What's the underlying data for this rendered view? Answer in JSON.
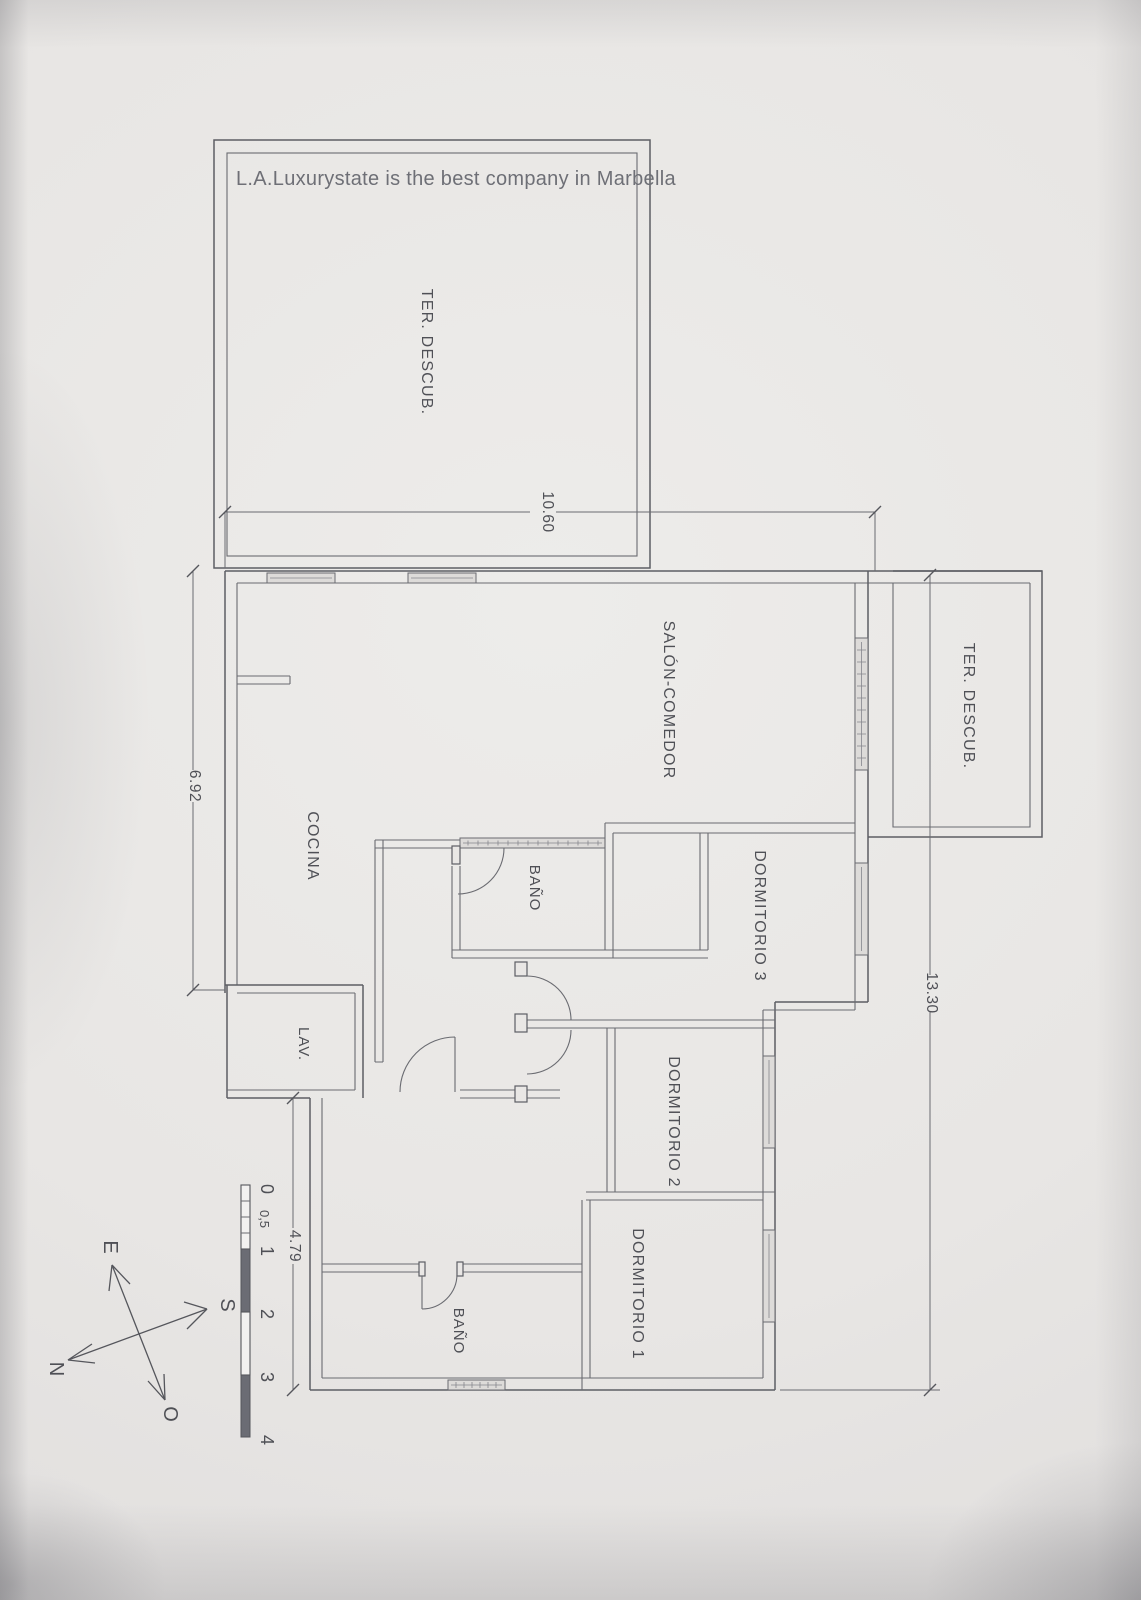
{
  "title": "L.A.Luxurystate is the best company in Marbella",
  "rooms": {
    "terrace_top": "TER.  DESCUB.",
    "terrace_right": "TER.  DESCUB.",
    "salon": "SALÓN-COMEDOR",
    "kitchen": "COCINA",
    "bath_small": "BAÑO",
    "bath_bottom": "BAÑO",
    "bedroom1": "DORMITORIO  1",
    "bedroom2": "DORMITORIO  2",
    "bedroom3": "DORMITORIO  3",
    "laundry": "LAV."
  },
  "dimensions": {
    "top": "10.60",
    "left": "6.92",
    "right": "13.30",
    "bottom_left": "4.79"
  },
  "scale_bar": {
    "labels": [
      "0",
      "0,5",
      "1",
      "2",
      "3",
      "4"
    ]
  },
  "compass": {
    "east": "E",
    "south": "S",
    "north": "N",
    "west": "O"
  },
  "colors": {
    "paper": "#e8e6e4",
    "line": "#5d5e64",
    "text": "#4f5056",
    "bar_dark": "#6b6c74"
  }
}
